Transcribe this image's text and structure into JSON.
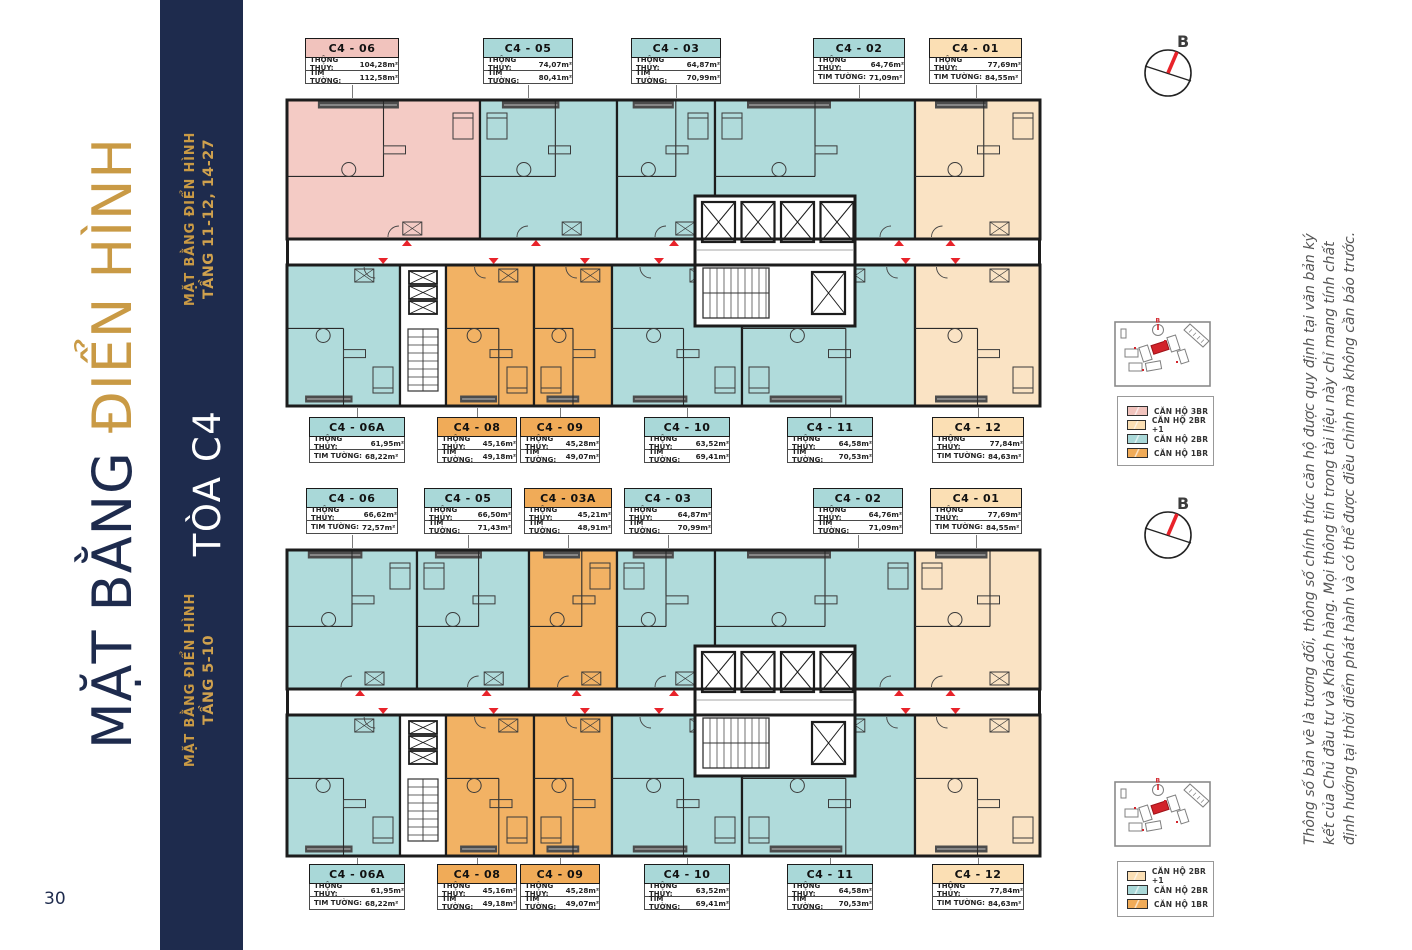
{
  "page": {
    "number": "30"
  },
  "sidebar": {
    "title_navy": "MẶT BẰNG ",
    "title_gold": "ĐIỂN HÌNH"
  },
  "band": {
    "top_group": {
      "title": "MẶT BẰNG ĐIỂN HÌNH",
      "subtitle": "TẦNG 11-12, 14-27"
    },
    "tower": "TÒA C4",
    "bottom_group": {
      "title": "MẶT BẰNG ĐIỂN HÌNH",
      "subtitle": "TẦNG 5-10"
    }
  },
  "field_labels": {
    "clear_area": "THÔNG THỦY:",
    "wall_area": "TIM TƯỜNG:"
  },
  "compass": {
    "label": "B"
  },
  "legend_top": [
    {
      "type": "pink",
      "label": "CĂN HỘ 3BR"
    },
    {
      "type": "cream",
      "label": "CĂN HỘ 2BR +1"
    },
    {
      "type": "teal",
      "label": "CĂN HỘ 2BR"
    },
    {
      "type": "orange",
      "label": "CĂN HỘ 1BR"
    }
  ],
  "legend_bottom": [
    {
      "type": "cream",
      "label": "CĂN HỘ 2BR +1"
    },
    {
      "type": "teal",
      "label": "CĂN HỘ 2BR"
    },
    {
      "type": "orange",
      "label": "CĂN HỘ 1BR"
    }
  ],
  "colors": {
    "navy": "#1e2b4d",
    "gold": "#c99a45",
    "red": "#e8232a",
    "wall": "#1c1c1c",
    "pink": "#f4cbc5",
    "teal": "#b0dbdb",
    "orange": "#f2b264",
    "cream": "#fae3c4",
    "header": {
      "pink": "#f1c3bd",
      "teal": "#a9d8d8",
      "orange": "#f0ab58",
      "cream": "#fbdfb4"
    }
  },
  "plans": [
    {
      "id": "floors-11-12-14-27",
      "top_labels": [
        {
          "name": "C4 - 06",
          "type": "pink",
          "clear": "104,28m²",
          "wall": "112,58m²",
          "x": 305,
          "w": 94
        },
        {
          "name": "C4 - 05",
          "type": "teal",
          "clear": "74,07m²",
          "wall": "80,41m²",
          "x": 483,
          "w": 90
        },
        {
          "name": "C4 - 03",
          "type": "teal",
          "clear": "64,87m²",
          "wall": "70,99m²",
          "x": 631,
          "w": 90
        },
        {
          "name": "C4 - 02",
          "type": "teal",
          "clear": "64,76m²",
          "wall": "71,09m²",
          "x": 813,
          "w": 92
        },
        {
          "name": "C4 - 01",
          "type": "cream",
          "clear": "77,69m²",
          "wall": "84,55m²",
          "x": 929,
          "w": 93
        }
      ],
      "bottom_labels": [
        {
          "name": "C4 - 06A",
          "type": "teal",
          "clear": "61,95m²",
          "wall": "68,22m²",
          "x": 309,
          "w": 96
        },
        {
          "name": "C4 - 08",
          "type": "orange",
          "clear": "45,16m²",
          "wall": "49,18m²",
          "x": 437,
          "w": 80
        },
        {
          "name": "C4 - 09",
          "type": "orange",
          "clear": "45,28m²",
          "wall": "49,07m²",
          "x": 520,
          "w": 80
        },
        {
          "name": "C4 - 10",
          "type": "teal",
          "clear": "63,52m²",
          "wall": "69,41m²",
          "x": 644,
          "w": 86
        },
        {
          "name": "C4 - 11",
          "type": "teal",
          "clear": "64,58m²",
          "wall": "70,53m²",
          "x": 787,
          "w": 86
        },
        {
          "name": "C4 - 12",
          "type": "cream",
          "clear": "77,84m²",
          "wall": "84,63m²",
          "x": 932,
          "w": 92
        }
      ],
      "units_top": [
        {
          "id": "C4-06",
          "type": "pink",
          "x": 2,
          "w": 193,
          "door": 0.58
        },
        {
          "id": "C4-05",
          "type": "teal",
          "x": 195,
          "w": 137,
          "door": 0.35
        },
        {
          "id": "C4-03",
          "type": "teal",
          "x": 332,
          "w": 98,
          "door": 0.5
        },
        {
          "id": "C4-02",
          "type": "teal",
          "x": 430,
          "w": 200,
          "door": 0.88
        },
        {
          "id": "C4-01",
          "type": "cream",
          "x": 630,
          "w": 125,
          "door": 0.22
        }
      ],
      "units_bottom": [
        {
          "id": "C4-06A",
          "type": "teal",
          "x": 2,
          "w": 113,
          "door": 0.78
        },
        {
          "id": "stairs",
          "type": "white",
          "x": 115,
          "w": 46
        },
        {
          "id": "C4-08",
          "type": "orange",
          "x": 161,
          "w": 88,
          "door": 0.45
        },
        {
          "id": "C4-09",
          "type": "orange",
          "x": 249,
          "w": 78,
          "door": 0.55
        },
        {
          "id": "C4-10",
          "type": "teal",
          "x": 327,
          "w": 130,
          "door": 0.3
        },
        {
          "id": "C4-11",
          "type": "teal",
          "x": 457,
          "w": 173,
          "door": 0.9
        },
        {
          "id": "C4-12",
          "type": "cream",
          "x": 630,
          "w": 125,
          "door": 0.26
        }
      ]
    },
    {
      "id": "floors-5-10",
      "top_labels": [
        {
          "name": "C4 - 06",
          "type": "teal",
          "clear": "66,62m²",
          "wall": "72,57m²",
          "x": 306,
          "w": 92
        },
        {
          "name": "C4 - 05",
          "type": "teal",
          "clear": "66,50m²",
          "wall": "71,43m²",
          "x": 424,
          "w": 88
        },
        {
          "name": "C4 - 03A",
          "type": "orange",
          "clear": "45,21m²",
          "wall": "48,91m²",
          "x": 524,
          "w": 88
        },
        {
          "name": "C4 - 03",
          "type": "teal",
          "clear": "64,87m²",
          "wall": "70,99m²",
          "x": 624,
          "w": 88
        },
        {
          "name": "C4 - 02",
          "type": "teal",
          "clear": "64,76m²",
          "wall": "71,09m²",
          "x": 813,
          "w": 90
        },
        {
          "name": "C4 - 01",
          "type": "cream",
          "clear": "77,69m²",
          "wall": "84,55m²",
          "x": 930,
          "w": 92
        }
      ],
      "bottom_labels": [
        {
          "name": "C4 - 06A",
          "type": "teal",
          "clear": "61,95m²",
          "wall": "68,22m²",
          "x": 309,
          "w": 96
        },
        {
          "name": "C4 - 08",
          "type": "orange",
          "clear": "45,16m²",
          "wall": "49,18m²",
          "x": 437,
          "w": 80
        },
        {
          "name": "C4 - 09",
          "type": "orange",
          "clear": "45,28m²",
          "wall": "49,07m²",
          "x": 520,
          "w": 80
        },
        {
          "name": "C4 - 10",
          "type": "teal",
          "clear": "63,52m²",
          "wall": "69,41m²",
          "x": 644,
          "w": 86
        },
        {
          "name": "C4 - 11",
          "type": "teal",
          "clear": "64,58m²",
          "wall": "70,53m²",
          "x": 787,
          "w": 86
        },
        {
          "name": "C4 - 12",
          "type": "cream",
          "clear": "77,84m²",
          "wall": "84,63m²",
          "x": 932,
          "w": 92
        }
      ],
      "units_top": [
        {
          "id": "C4-06",
          "type": "teal",
          "x": 2,
          "w": 130,
          "door": 0.5
        },
        {
          "id": "C4-05",
          "type": "teal",
          "x": 132,
          "w": 112,
          "door": 0.55
        },
        {
          "id": "C4-03A",
          "type": "orange",
          "x": 244,
          "w": 88,
          "door": 0.45
        },
        {
          "id": "C4-03",
          "type": "teal",
          "x": 332,
          "w": 98,
          "door": 0.5
        },
        {
          "id": "C4-02",
          "type": "teal",
          "x": 430,
          "w": 200,
          "door": 0.88
        },
        {
          "id": "C4-01",
          "type": "cream",
          "x": 630,
          "w": 125,
          "door": 0.22
        }
      ],
      "units_bottom": [
        {
          "id": "C4-06A",
          "type": "teal",
          "x": 2,
          "w": 113,
          "door": 0.78
        },
        {
          "id": "stairs",
          "type": "white",
          "x": 115,
          "w": 46
        },
        {
          "id": "C4-08",
          "type": "orange",
          "x": 161,
          "w": 88,
          "door": 0.45
        },
        {
          "id": "C4-09",
          "type": "orange",
          "x": 249,
          "w": 78,
          "door": 0.55
        },
        {
          "id": "C4-10",
          "type": "teal",
          "x": 327,
          "w": 130,
          "door": 0.3
        },
        {
          "id": "C4-11",
          "type": "teal",
          "x": 457,
          "w": 173,
          "door": 0.9
        },
        {
          "id": "C4-12",
          "type": "cream",
          "x": 630,
          "w": 125,
          "door": 0.26
        }
      ]
    }
  ],
  "disclaimer": [
    "Thông số bản vẽ là tương đối, thông số chính thức căn hộ được quy định tại văn bản ký",
    "kết của Chủ đầu tư và Khách hàng. Mọi thông tin trong tài liệu này chỉ mang tính chất",
    "định hướng tại thời điểm phát hành và có thể được điều chỉnh mà không cần báo trước."
  ]
}
